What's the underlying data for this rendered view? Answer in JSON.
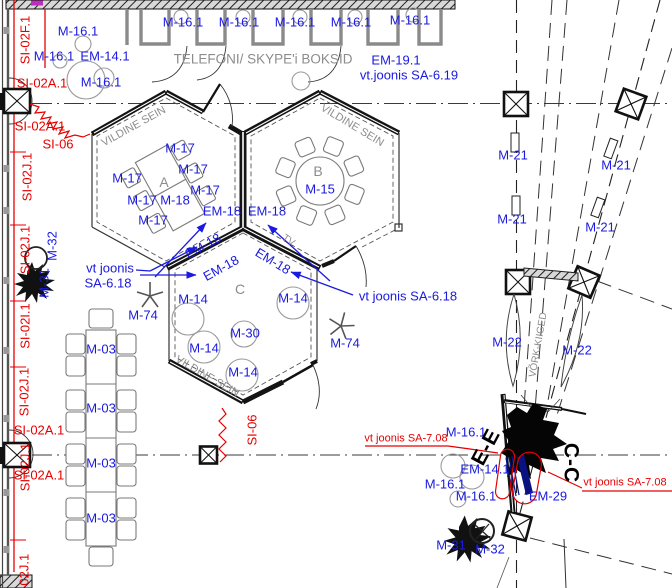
{
  "drawing_title": "TELEFONI/ SKYPE'i BOKSID",
  "palette": {
    "annotation_blue": "#1a1ae0",
    "annotation_red": "#e60000",
    "annotation_gray": "#8c8c8c",
    "wall_black": "#141414",
    "element_navy": "#0a1280",
    "accent_magenta": "#bb2fbb"
  },
  "labels": {
    "blue": [
      {
        "t": "M-16.1",
        "x": 183,
        "y": 22
      },
      {
        "t": "M-16.1",
        "x": 239,
        "y": 22
      },
      {
        "t": "M-16.1",
        "x": 295,
        "y": 22
      },
      {
        "t": "M-16.1",
        "x": 351,
        "y": 22
      },
      {
        "t": "M-16.1",
        "x": 410,
        "y": 20
      },
      {
        "t": "M-16.1",
        "x": 78,
        "y": 31
      },
      {
        "t": "M-16.1",
        "x": 54,
        "y": 56
      },
      {
        "t": "EM-14.1",
        "x": 105,
        "y": 56
      },
      {
        "t": "M-16.1",
        "x": 101,
        "y": 82
      },
      {
        "t": "EM-19.1",
        "x": 396,
        "y": 60
      },
      {
        "t": "vt.joonis SA-6.19",
        "x": 409,
        "y": 75
      },
      {
        "t": "M-17",
        "x": 180,
        "y": 148
      },
      {
        "t": "M-17",
        "x": 193,
        "y": 169
      },
      {
        "t": "M-17",
        "x": 205,
        "y": 190
      },
      {
        "t": "M-17",
        "x": 127,
        "y": 178
      },
      {
        "t": "M-17",
        "x": 142,
        "y": 200
      },
      {
        "t": "M-17",
        "x": 153,
        "y": 220
      },
      {
        "t": "M-18",
        "x": 175,
        "y": 200
      },
      {
        "t": "M-15",
        "x": 320,
        "y": 189
      },
      {
        "t": "EM-18",
        "x": 222,
        "y": 211
      },
      {
        "t": "EM-18",
        "x": 267,
        "y": 211
      },
      {
        "t": "EM-18",
        "x": 203,
        "y": 246,
        "r": -29
      },
      {
        "t": "EM-18",
        "x": 221,
        "y": 268,
        "r": -29
      },
      {
        "t": "EM-18",
        "x": 273,
        "y": 261,
        "r": 31
      },
      {
        "t": "vt joonis",
        "x": 110,
        "y": 268
      },
      {
        "t": "SA-6.18",
        "x": 108,
        "y": 283
      },
      {
        "t": "vt joonis SA-6.18",
        "x": 408,
        "y": 296
      },
      {
        "t": "M-74",
        "x": 143,
        "y": 315
      },
      {
        "t": "M-74",
        "x": 345,
        "y": 343
      },
      {
        "t": "M-14",
        "x": 193,
        "y": 299
      },
      {
        "t": "M-14",
        "x": 204,
        "y": 348
      },
      {
        "t": "M-14",
        "x": 243,
        "y": 372
      },
      {
        "t": "M-14",
        "x": 293,
        "y": 298
      },
      {
        "t": "M-30",
        "x": 245,
        "y": 333
      },
      {
        "t": "M-03",
        "x": 101,
        "y": 349
      },
      {
        "t": "M-03",
        "x": 101,
        "y": 408
      },
      {
        "t": "M-03",
        "x": 101,
        "y": 463
      },
      {
        "t": "M-03",
        "x": 101,
        "y": 518
      },
      {
        "t": "M-21",
        "x": 513,
        "y": 155
      },
      {
        "t": "M-21",
        "x": 616,
        "y": 165
      },
      {
        "t": "M-21",
        "x": 512,
        "y": 219
      },
      {
        "t": "M-21",
        "x": 600,
        "y": 227
      },
      {
        "t": "M-22",
        "x": 507,
        "y": 342
      },
      {
        "t": "M-22",
        "x": 577,
        "y": 350
      },
      {
        "t": "M-32",
        "x": 52,
        "y": 246,
        "r": -90
      },
      {
        "t": "M-31",
        "x": 44,
        "y": 283,
        "r": -90
      },
      {
        "t": "M-16.1",
        "x": 466,
        "y": 432
      },
      {
        "t": "EM-14.1",
        "x": 485,
        "y": 469
      },
      {
        "t": "M-16.1",
        "x": 445,
        "y": 484
      },
      {
        "t": "M-16.1",
        "x": 476,
        "y": 496
      },
      {
        "t": "EM-29",
        "x": 548,
        "y": 496
      },
      {
        "t": "M-31",
        "x": 451,
        "y": 545
      },
      {
        "t": "M-32",
        "x": 490,
        "y": 549
      }
    ],
    "red": [
      {
        "t": "SI-02A.1",
        "x": 42,
        "y": 83
      },
      {
        "t": "SI-02A.1",
        "x": 40,
        "y": 126
      },
      {
        "t": "SI-06",
        "x": 58,
        "y": 144
      },
      {
        "t": "SI-02A.1",
        "x": 39,
        "y": 430
      },
      {
        "t": "SI-02A.1",
        "x": 39,
        "y": 475
      },
      {
        "t": "SI-06",
        "x": 252,
        "y": 430,
        "r": -90
      },
      {
        "t": "SI-02F.1",
        "x": 25,
        "y": 40,
        "r": -90
      },
      {
        "t": "SI-02J.1",
        "x": 27,
        "y": 177,
        "r": -90
      },
      {
        "t": "SI-02J.1",
        "x": 25,
        "y": 250,
        "r": -90
      },
      {
        "t": "SI-02I.1",
        "x": 25,
        "y": 326,
        "r": -90
      },
      {
        "t": "SI-02J.1",
        "x": 24,
        "y": 392,
        "r": -90
      },
      {
        "t": "SI-02J.1",
        "x": 25,
        "y": 467,
        "r": -90
      },
      {
        "t": "SI-02J.1",
        "x": 24,
        "y": 578,
        "r": -90
      },
      {
        "t": "vt joonis SA-7.08",
        "x": 406,
        "y": 439,
        "s": 11
      },
      {
        "t": "vt joonis SA-7.08",
        "x": 625,
        "y": 483,
        "s": 11
      }
    ],
    "gray": [
      {
        "t": "TELEFONI/ SKYPE'i BOKSID",
        "x": 263,
        "y": 59,
        "s": 13.5
      },
      {
        "t": "VILDINE SEIN",
        "x": 134,
        "y": 127,
        "r": -29,
        "s": 11
      },
      {
        "t": "VILDINE SEIN",
        "x": 352,
        "y": 126,
        "r": 31,
        "s": 11
      },
      {
        "t": "VILDINE SEIN",
        "x": 207,
        "y": 377,
        "r": 30,
        "s": 11
      },
      {
        "t": "VÕRK-KIIGED",
        "x": 539,
        "y": 345,
        "r": -80,
        "s": 10
      },
      {
        "t": "A",
        "x": 164,
        "y": 182,
        "s": 14
      },
      {
        "t": "B",
        "x": 318,
        "y": 171,
        "s": 14
      },
      {
        "t": "C",
        "x": 240,
        "y": 289,
        "s": 14
      },
      {
        "t": "TV",
        "x": 288,
        "y": 241,
        "r": 35,
        "s": 10
      }
    ],
    "section": [
      {
        "t": "E-E",
        "x": 486,
        "y": 447,
        "r": -62,
        "s": 21
      },
      {
        "t": "C-C",
        "x": 571,
        "y": 463,
        "r": 90,
        "s": 21
      }
    ]
  }
}
